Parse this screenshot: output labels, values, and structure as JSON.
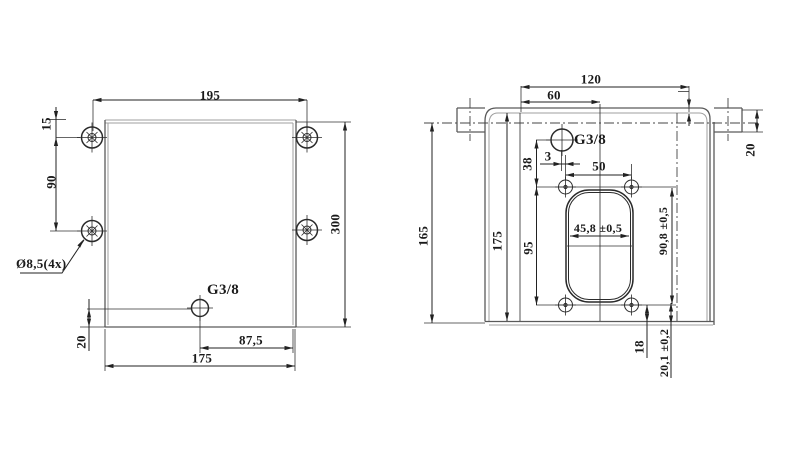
{
  "left_view": {
    "dims": {
      "width_top": "195",
      "edge_offset": "15",
      "hole_spacing": "90",
      "hole_diameter_note": "Ø8,5(4x)",
      "port": "G3/8",
      "bottom_offset": "20",
      "port_from_right": "87,5",
      "width_bottom": "175",
      "height": "300"
    }
  },
  "right_view": {
    "dims": {
      "width_total": "120",
      "width_center": "60",
      "port": "G3/8",
      "port_offset": "3",
      "port_to_holes": "38",
      "hole_spacing_h": "50",
      "slot_width": "45,8 ±0,5",
      "slot_height": "90,8 ±0,5",
      "hole_spacing_v": "95",
      "flange_height": "165",
      "total_height": "175",
      "tab_width": "20",
      "hole_to_bottom": "18",
      "slot_to_bottom": "20,1 ±0,2"
    }
  },
  "colors": {
    "background": "#ffffff",
    "line_dark": "#222222",
    "line_medium": "#5a5a5a",
    "line_light": "#9f9f9f"
  }
}
